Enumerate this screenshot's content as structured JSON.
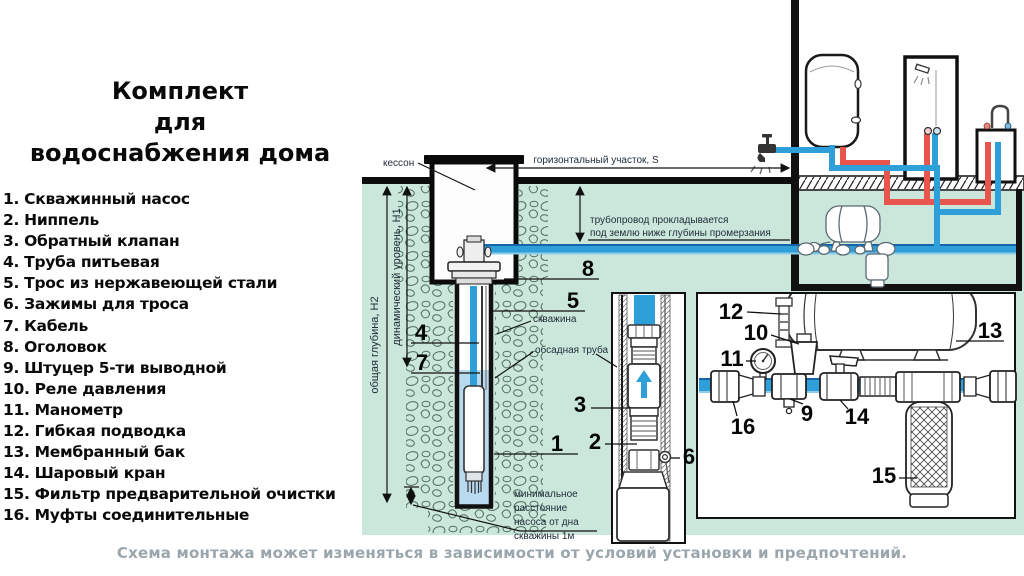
{
  "left_panel": {
    "title_lines": [
      "Комплект",
      "для",
      "водоснабжения дома"
    ],
    "items": [
      "1. Скважинный насос",
      "2. Ниппель",
      "3. Обратный клапан",
      "4. Труба питьевая",
      "5. Трос из нержавеющей стали",
      "6. Зажимы для троса",
      "7. Кабель",
      "8. Оголовок",
      "9. Штуцер 5-ти выводной",
      "10. Реле давления",
      "11. Манометр",
      "12. Гибкая подводка",
      "13. Мембранный бак",
      "14. Шаровый кран",
      "15. Фильтр предварительной очистки",
      "16. Муфты соединительные"
    ]
  },
  "diagram": {
    "labels": {
      "kesson": "кессон",
      "horizontal_section": "горизонтальный участок,  S",
      "pipeline_line1": "трубопровод прокладывается",
      "pipeline_line2": "под землю ниже глубины промерзания",
      "well": "скважина",
      "casing_pipe": "обсадная труба",
      "min_line1": "минимальное",
      "min_line2": "расстояние",
      "min_line3": "насоса от дна",
      "min_line4": "скважины 1м",
      "depth_total": "общая глубина, Н2",
      "depth_dynamic": "динамический уровень, Н1"
    },
    "callouts": {
      "c1": "1",
      "c2": "2",
      "c3": "3",
      "c4": "4",
      "c5": "5",
      "c6": "6",
      "c7": "7",
      "c8": "8",
      "c9": "9",
      "c10": "10",
      "c11": "11",
      "c12": "12",
      "c13": "13",
      "c14": "14",
      "c15": "15",
      "c16": "16"
    },
    "colors": {
      "ground_mint": "#cbe6da",
      "pipe_cold_blue": "#2e9fd9",
      "pipe_hot_red": "#e8554c",
      "well_water": "#b8d9ee",
      "line_black": "#111111",
      "caption_gray": "#9ba6ac"
    }
  },
  "footer": {
    "caption": "Схема монтажа может изменяться в зависимости от условий установки и предпочтений."
  }
}
